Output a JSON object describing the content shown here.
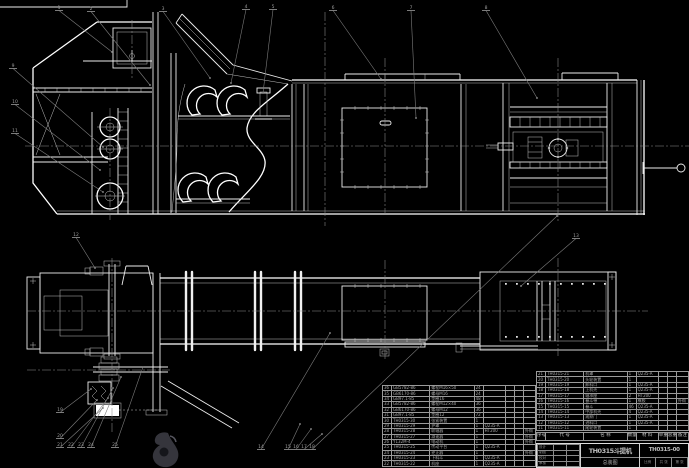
{
  "title_block": {
    "product": "TH0315斗提机",
    "title": "总装图",
    "drawing_no": "TH0315-00",
    "sign_rows": [
      [
        "设计",
        "",
        ""
      ],
      [
        "制图",
        "",
        ""
      ],
      [
        "校对",
        "",
        ""
      ],
      [
        "审核",
        "",
        ""
      ]
    ],
    "footer_cells": [
      [
        "比例",
        "共 张",
        "第 张"
      ]
    ]
  },
  "bom": {
    "header_row": [
      [
        "序号",
        "代  号",
        "名  称",
        "数量",
        "材  料",
        "单重",
        "总重",
        "备注"
      ]
    ],
    "right_rows": [
      [
        "21",
        "TH0315-21",
        "机罩",
        "1",
        "Q235-A",
        "",
        "",
        ""
      ],
      [
        "20",
        "TH0315-20",
        "头轮装置",
        "1",
        "",
        "",
        "",
        ""
      ],
      [
        "19",
        "TH0315-19",
        "卸料口",
        "1",
        "Q235-A",
        "",
        "",
        ""
      ],
      [
        "18",
        "TH0315-18",
        "上机壳",
        "1",
        "Q235-A",
        "",
        "",
        ""
      ],
      [
        "17",
        "TH0315-17",
        "轴承座",
        "2",
        "HT200",
        "",
        "",
        ""
      ],
      [
        "16",
        "TH0315-16",
        "畚斗带",
        "1",
        "橡胶",
        "",
        "",
        "外购"
      ],
      [
        "15",
        "TH0315-15",
        "畚斗",
        "46",
        "Q235-A",
        "",
        "",
        ""
      ],
      [
        "14",
        "TH0315-14",
        "中部机壳",
        "4",
        "Q235-A",
        "",
        "",
        ""
      ],
      [
        "13",
        "TH0315-13",
        "观察门",
        "1",
        "Q235-A",
        "",
        "",
        ""
      ],
      [
        "12",
        "TH0315-12",
        "进料口",
        "1",
        "Q235-A",
        "",
        "",
        ""
      ],
      [
        "11",
        "TH0315-11",
        "尾轮装置",
        "1",
        "",
        "",
        "",
        ""
      ]
    ],
    "left_rows": [
      [
        "36",
        "GB5782-86",
        "螺栓M16×50",
        "24",
        "",
        "",
        "",
        ""
      ],
      [
        "35",
        "GB6170-86",
        "螺母M16",
        "24",
        "",
        "",
        "",
        ""
      ],
      [
        "34",
        "GB97.1-85",
        "垫圈16",
        "48",
        "",
        "",
        "",
        ""
      ],
      [
        "33",
        "GB5782-86",
        "螺栓M12×40",
        "36",
        "",
        "",
        "",
        ""
      ],
      [
        "32",
        "GB6170-86",
        "螺母M12",
        "36",
        "",
        "",
        "",
        ""
      ],
      [
        "31",
        "GB97.1-85",
        "垫圈12",
        "72",
        "",
        "",
        "",
        ""
      ],
      [
        "30",
        "TH0315-30",
        "张紧装置",
        "1",
        "",
        "",
        "",
        ""
      ],
      [
        "29",
        "TH0315-29",
        "护罩",
        "1",
        "Q235-A",
        "",
        "",
        ""
      ],
      [
        "28",
        "TH0315-28",
        "联轴器",
        "1",
        "HT200",
        "",
        "",
        "外购"
      ],
      [
        "27",
        "TH0315-27",
        "减速器",
        "1",
        "",
        "",
        "",
        "外购"
      ],
      [
        "26",
        "Y132M-4",
        "电动机",
        "1",
        "",
        "",
        "",
        "外购"
      ],
      [
        "25",
        "TH0315-25",
        "传动平台",
        "1",
        "Q235-A",
        "",
        "",
        ""
      ],
      [
        "24",
        "TH0315-24",
        "逆止器",
        "1",
        "",
        "",
        "",
        "外购"
      ],
      [
        "23",
        "TH0315-23",
        "下料斗",
        "1",
        "Q235-A",
        "",
        "",
        ""
      ],
      [
        "22",
        "TH0315-22",
        "机座",
        "1",
        "Q235-A",
        "",
        "",
        ""
      ]
    ]
  },
  "callouts": [
    {
      "n": "1",
      "x": 56,
      "y": 9,
      "tx": 112,
      "ty": 52
    },
    {
      "n": "2",
      "x": 88,
      "y": 10,
      "tx": 150,
      "ty": 85
    },
    {
      "n": "3",
      "x": 160,
      "y": 10,
      "tx": 210,
      "ty": 78
    },
    {
      "n": "4",
      "x": 243,
      "y": 8,
      "tx": 231,
      "ty": 83
    },
    {
      "n": "5",
      "x": 270,
      "y": 8,
      "tx": 263,
      "ty": 93
    },
    {
      "n": "6",
      "x": 330,
      "y": 9,
      "tx": 381,
      "ty": 79
    },
    {
      "n": "7",
      "x": 408,
      "y": 9,
      "tx": 416,
      "ty": 118
    },
    {
      "n": "8",
      "x": 483,
      "y": 9,
      "tx": 537,
      "ty": 98
    },
    {
      "n": "9",
      "x": 10,
      "y": 67,
      "tx": 103,
      "ty": 147
    },
    {
      "n": "10",
      "x": 12,
      "y": 103,
      "tx": 100,
      "ty": 170
    },
    {
      "n": "11",
      "x": 12,
      "y": 132,
      "tx": 103,
      "ty": 192
    },
    {
      "n": "12",
      "x": 73,
      "y": 236,
      "tx": 95,
      "ty": 268
    },
    {
      "n": "13",
      "x": 573,
      "y": 237,
      "tx": 521,
      "ty": 286
    },
    {
      "n": "14",
      "x": 258,
      "y": 448,
      "tx": 330,
      "ty": 333
    },
    {
      "n": "15",
      "x": 285,
      "y": 448,
      "tx": 300,
      "ty": 424
    },
    {
      "n": "16",
      "x": 293,
      "y": 448,
      "tx": 311,
      "ty": 429
    },
    {
      "n": "17",
      "x": 301,
      "y": 448,
      "tx": 322,
      "ty": 434
    },
    {
      "n": "18",
      "x": 309,
      "y": 448,
      "tx": 557,
      "ty": 216
    },
    {
      "n": "19",
      "x": 57,
      "y": 411,
      "tx": 91,
      "ty": 389
    },
    {
      "n": "20",
      "x": 57,
      "y": 437,
      "tx": 97,
      "ty": 400
    },
    {
      "n": "21",
      "x": 57,
      "y": 446,
      "tx": 103,
      "ty": 408
    },
    {
      "n": "22",
      "x": 68,
      "y": 446,
      "tx": 108,
      "ty": 398
    },
    {
      "n": "23",
      "x": 78,
      "y": 446,
      "tx": 113,
      "ty": 388
    },
    {
      "n": "24",
      "x": 88,
      "y": 446,
      "tx": 121,
      "ty": 377
    },
    {
      "n": "25",
      "x": 112,
      "y": 446,
      "tx": 143,
      "ty": 367
    }
  ]
}
